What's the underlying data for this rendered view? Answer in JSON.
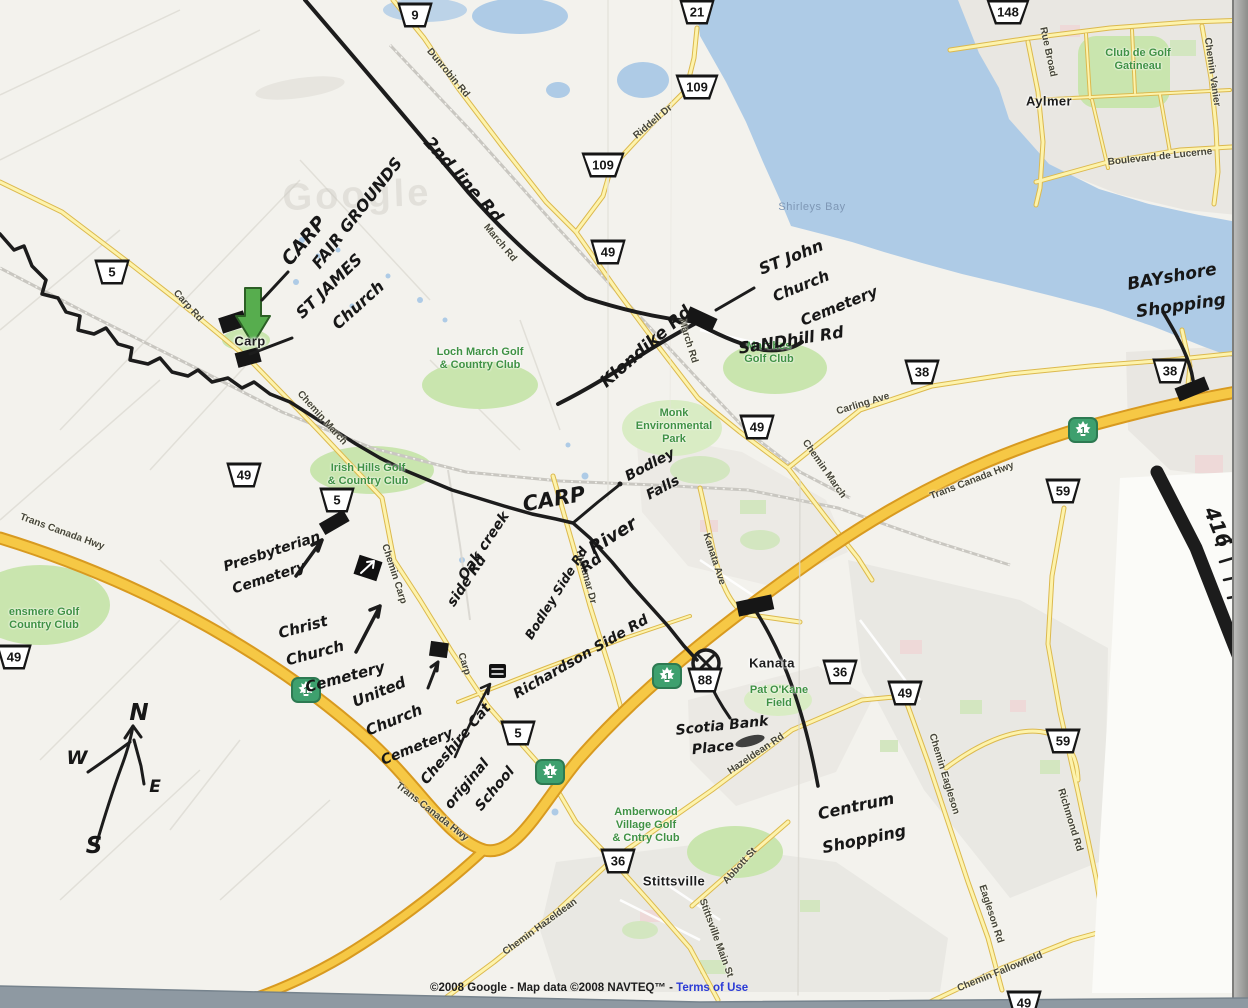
{
  "watermark": "Google",
  "copyright": {
    "prefix": "©2008 Google - Map data ©2008 NAVTEQ™ - ",
    "link": "Terms of Use"
  },
  "towns": [
    {
      "text": "Carp",
      "x": 250,
      "y": 341
    },
    {
      "text": "Kanata",
      "x": 772,
      "y": 663
    },
    {
      "text": "Stittsville",
      "x": 674,
      "y": 881
    },
    {
      "text": "Aylmer",
      "x": 1049,
      "y": 101
    }
  ],
  "water_labels": [
    {
      "text": "Shirleys Bay",
      "x": 812,
      "y": 207
    }
  ],
  "green_labels": [
    {
      "lines": [
        "Loch March Golf",
        "& Country Club"
      ],
      "x": 480,
      "y": 352
    },
    {
      "lines": [
        "Marshes",
        "Golf Club"
      ],
      "x": 769,
      "y": 346
    },
    {
      "lines": [
        "Irish Hills Golf",
        "& Country Club"
      ],
      "x": 368,
      "y": 468
    },
    {
      "lines": [
        "Monk",
        "Environmental",
        "Park"
      ],
      "x": 674,
      "y": 413
    },
    {
      "lines": [
        "ensmere Golf",
        "Country Club"
      ],
      "x": 44,
      "y": 612
    },
    {
      "lines": [
        "Amberwood",
        "Village Golf",
        "& Cntry Club"
      ],
      "x": 646,
      "y": 812
    },
    {
      "lines": [
        "Club de Golf",
        "Gatineau"
      ],
      "x": 1138,
      "y": 53
    },
    {
      "lines": [
        "Pat O'Kane",
        "Field"
      ],
      "x": 779,
      "y": 690
    }
  ],
  "road_labels": [
    {
      "text": "Dunrobin Rd",
      "x": 448,
      "y": 73,
      "rot": 50
    },
    {
      "text": "March Rd",
      "x": 500,
      "y": 243,
      "rot": 50
    },
    {
      "text": "Riddell Dr",
      "x": 653,
      "y": 122,
      "rot": -40
    },
    {
      "text": "Carp Rd",
      "x": 188,
      "y": 306,
      "rot": 48
    },
    {
      "text": "Chemin March",
      "x": 322,
      "y": 418,
      "rot": 48
    },
    {
      "text": "March Rd",
      "x": 688,
      "y": 341,
      "rot": 73
    },
    {
      "text": "Chemin March",
      "x": 824,
      "y": 469,
      "rot": 55
    },
    {
      "text": "Carling Ave",
      "x": 863,
      "y": 404,
      "rot": -17
    },
    {
      "text": "Chemin Carp",
      "x": 394,
      "y": 574,
      "rot": 72
    },
    {
      "text": "Carp",
      "x": 464,
      "y": 664,
      "rot": 72
    },
    {
      "text": "Trans Canada Hwy",
      "x": 62,
      "y": 532,
      "rot": 20
    },
    {
      "text": "Trans Canada Hwy",
      "x": 432,
      "y": 812,
      "rot": 38
    },
    {
      "text": "Trans Canada Hwy",
      "x": 972,
      "y": 481,
      "rot": -21
    },
    {
      "text": "Hazeldean Rd",
      "x": 756,
      "y": 754,
      "rot": -34
    },
    {
      "text": "Chemin Hazeldean",
      "x": 540,
      "y": 927,
      "rot": -36
    },
    {
      "text": "Stittsville Main St",
      "x": 716,
      "y": 938,
      "rot": 70
    },
    {
      "text": "Abbott St",
      "x": 740,
      "y": 866,
      "rot": -48
    },
    {
      "text": "Chemin Eagleson",
      "x": 944,
      "y": 774,
      "rot": 73
    },
    {
      "text": "Eagleson Rd",
      "x": 991,
      "y": 914,
      "rot": 72
    },
    {
      "text": "Chemin Fallowfield",
      "x": 1000,
      "y": 972,
      "rot": -22
    },
    {
      "text": "Richmond Rd",
      "x": 1070,
      "y": 820,
      "rot": 73
    },
    {
      "text": "Kanata Ave",
      "x": 714,
      "y": 559,
      "rot": 72
    },
    {
      "text": "Huntmar Dr",
      "x": 586,
      "y": 577,
      "rot": 75
    },
    {
      "text": "Rue Broad",
      "x": 1048,
      "y": 52,
      "rot": 78
    },
    {
      "text": "Chemin Vanier",
      "x": 1212,
      "y": 72,
      "rot": 82
    },
    {
      "text": "Boulevard de Lucerne",
      "x": 1160,
      "y": 157,
      "rot": -6
    }
  ],
  "shields": [
    {
      "num": "9",
      "x": 415,
      "y": 15
    },
    {
      "num": "21",
      "x": 697,
      "y": 12
    },
    {
      "num": "109",
      "x": 697,
      "y": 87
    },
    {
      "num": "109",
      "x": 603,
      "y": 165
    },
    {
      "num": "49",
      "x": 608,
      "y": 252
    },
    {
      "num": "5",
      "x": 112,
      "y": 272
    },
    {
      "num": "148",
      "x": 1008,
      "y": 12
    },
    {
      "num": "49",
      "x": 244,
      "y": 475
    },
    {
      "num": "5",
      "x": 337,
      "y": 500
    },
    {
      "num": "49",
      "x": 14,
      "y": 657
    },
    {
      "num": "49",
      "x": 757,
      "y": 427
    },
    {
      "num": "38",
      "x": 922,
      "y": 372
    },
    {
      "num": "38",
      "x": 1170,
      "y": 371
    },
    {
      "num": "59",
      "x": 1063,
      "y": 491
    },
    {
      "num": "5",
      "x": 518,
      "y": 733
    },
    {
      "num": "36",
      "x": 840,
      "y": 672
    },
    {
      "num": "49",
      "x": 905,
      "y": 693
    },
    {
      "num": "88",
      "x": 705,
      "y": 680
    },
    {
      "num": "59",
      "x": 1063,
      "y": 741
    },
    {
      "num": "36",
      "x": 618,
      "y": 861
    },
    {
      "num": "49",
      "x": 1024,
      "y": 1003
    }
  ],
  "tc_markers": [
    {
      "label": "1",
      "x": 1083,
      "y": 430
    },
    {
      "label": "1",
      "x": 667,
      "y": 676
    },
    {
      "label": "1",
      "x": 550,
      "y": 772
    },
    {
      "label": "1",
      "x": 306,
      "y": 690
    }
  ],
  "handwriting": [
    {
      "text": "2nd line Rd",
      "x": 463,
      "y": 180,
      "rot": 48,
      "size": 17
    },
    {
      "text": "CARP",
      "x": 304,
      "y": 241,
      "rot": -50,
      "size": 19
    },
    {
      "text": "FAIR GROUNDS",
      "x": 357,
      "y": 213,
      "rot": -52,
      "size": 16
    },
    {
      "text": "ST JAMES",
      "x": 329,
      "y": 286,
      "rot": -44,
      "size": 16
    },
    {
      "text": "Church",
      "x": 358,
      "y": 305,
      "rot": -42,
      "size": 16
    },
    {
      "text": "Klondike Rd",
      "x": 646,
      "y": 347,
      "rot": -41,
      "size": 17
    },
    {
      "text": "ST John",
      "x": 791,
      "y": 257,
      "rot": -22,
      "size": 16
    },
    {
      "text": "Church",
      "x": 801,
      "y": 286,
      "rot": -22,
      "size": 15
    },
    {
      "text": "Cemetery",
      "x": 839,
      "y": 306,
      "rot": -22,
      "size": 15
    },
    {
      "text": "SaNDhill Rd",
      "x": 791,
      "y": 340,
      "rot": -9,
      "size": 16
    },
    {
      "text": "BAYshore",
      "x": 1172,
      "y": 277,
      "rot": -10,
      "size": 17
    },
    {
      "text": "Shopping",
      "x": 1181,
      "y": 306,
      "rot": -8,
      "size": 17
    },
    {
      "text": "CARP",
      "x": 554,
      "y": 499,
      "rot": -10,
      "size": 21
    },
    {
      "text": "River",
      "x": 613,
      "y": 536,
      "rot": -32,
      "size": 18
    },
    {
      "text": "Rd",
      "x": 591,
      "y": 563,
      "rot": -36,
      "size": 15
    },
    {
      "text": "Bodley",
      "x": 650,
      "y": 465,
      "rot": -28,
      "size": 14
    },
    {
      "text": "Falls",
      "x": 663,
      "y": 488,
      "rot": -28,
      "size": 14
    },
    {
      "text": "Oak creek",
      "x": 484,
      "y": 546,
      "rot": -56,
      "size": 14
    },
    {
      "text": "side Rd",
      "x": 467,
      "y": 581,
      "rot": -56,
      "size": 14
    },
    {
      "text": "Bodley Side Rd",
      "x": 556,
      "y": 593,
      "rot": -58,
      "size": 12.5
    },
    {
      "text": "Richardson Side Rd",
      "x": 581,
      "y": 657,
      "rot": -30,
      "size": 14
    },
    {
      "text": "Presbyterian",
      "x": 272,
      "y": 552,
      "rot": -18,
      "size": 14
    },
    {
      "text": "Cemetery",
      "x": 269,
      "y": 578,
      "rot": -18,
      "size": 14
    },
    {
      "text": "Christ",
      "x": 303,
      "y": 627,
      "rot": -15,
      "size": 15
    },
    {
      "text": "Church",
      "x": 315,
      "y": 653,
      "rot": -15,
      "size": 15
    },
    {
      "text": "Cemetery",
      "x": 345,
      "y": 677,
      "rot": -15,
      "size": 15
    },
    {
      "text": "United",
      "x": 379,
      "y": 692,
      "rot": -22,
      "size": 15
    },
    {
      "text": "Church",
      "x": 394,
      "y": 720,
      "rot": -22,
      "size": 15
    },
    {
      "text": "Cemetery",
      "x": 417,
      "y": 747,
      "rot": -22,
      "size": 14
    },
    {
      "text": "Cheshire Cat",
      "x": 456,
      "y": 744,
      "rot": -50,
      "size": 14
    },
    {
      "text": "original",
      "x": 467,
      "y": 784,
      "rot": -50,
      "size": 14
    },
    {
      "text": "School",
      "x": 495,
      "y": 789,
      "rot": -50,
      "size": 14
    },
    {
      "text": "Scotia Bank",
      "x": 722,
      "y": 726,
      "rot": -6,
      "size": 14
    },
    {
      "text": "Place",
      "x": 713,
      "y": 748,
      "rot": -6,
      "size": 14
    },
    {
      "text": "Centrum",
      "x": 856,
      "y": 806,
      "rot": -12,
      "size": 16
    },
    {
      "text": "Shopping",
      "x": 864,
      "y": 839,
      "rot": -12,
      "size": 16
    },
    {
      "text": "416",
      "x": 1218,
      "y": 527,
      "rot": 68,
      "size": 20
    },
    {
      "text": "N",
      "x": 139,
      "y": 713,
      "rot": 0,
      "size": 23
    },
    {
      "text": "W",
      "x": 77,
      "y": 758,
      "rot": 0,
      "size": 19
    },
    {
      "text": "E",
      "x": 155,
      "y": 787,
      "rot": 0,
      "size": 17
    },
    {
      "text": "S",
      "x": 94,
      "y": 846,
      "rot": 0,
      "size": 23
    }
  ]
}
